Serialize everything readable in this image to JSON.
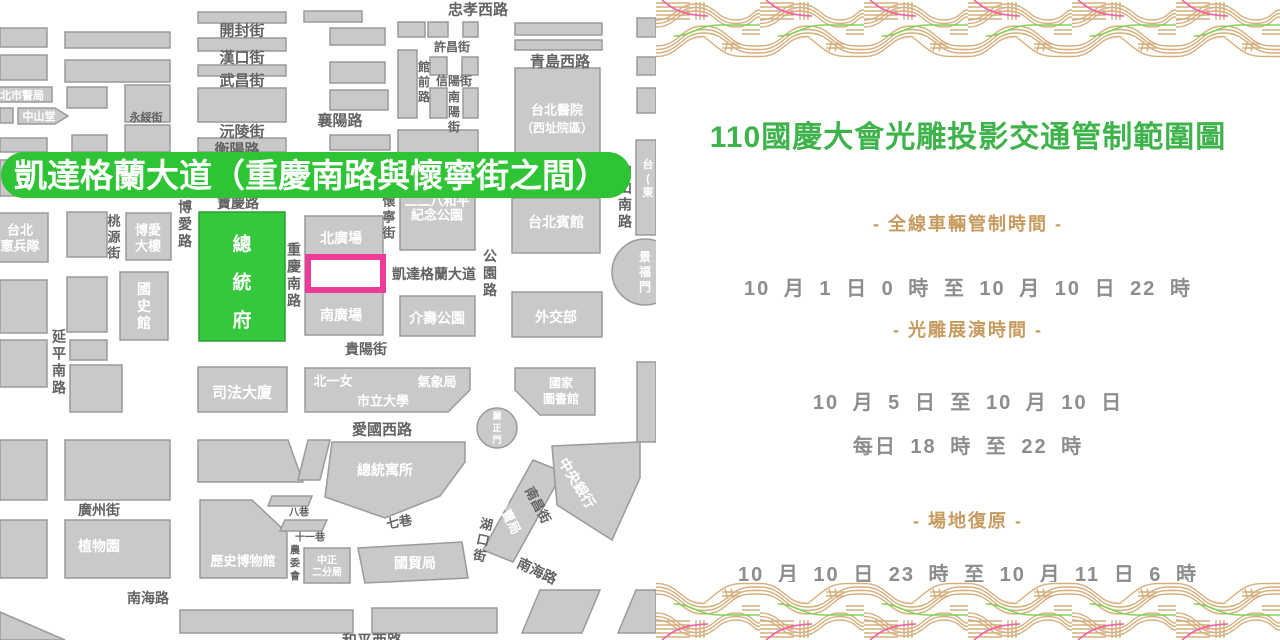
{
  "panel": {
    "title": "110國慶大會光雕投影交通管制範圍圖",
    "colors": {
      "title_green": "#3fb34b",
      "gold": "#c79b5f",
      "gray": "#8d8d8d"
    },
    "sections": [
      {
        "heading": "- 全線車輛管制時間 -",
        "lines": [
          "10 月  1 日 0 時 至  10 月 10 日 22 時"
        ]
      },
      {
        "heading": "- 光雕展演時間 -",
        "lines": [
          "10 月  5 日  至  10 月 10 日",
          "每日 18 時 至 22 時"
        ]
      },
      {
        "heading": "- 場地復原 -",
        "lines": [
          "10 月 10 日 23 時 至 10 月 11 日 6 時"
        ]
      }
    ]
  },
  "map": {
    "colors": {
      "block": "#c9c9cb",
      "blockBorder": "#9a9a9a",
      "street": "#636363",
      "green": "#35c83c",
      "greenBorder": "#2f9e33",
      "bannerGreen": "#2fc435",
      "pink": "#ee3a98"
    },
    "banner": {
      "text": "凱達格蘭大道（重慶南路與懷寧街之間）",
      "rect": [
        1,
        152,
        630,
        46
      ],
      "rx": 23,
      "fontSize": 33,
      "textX": 14,
      "textY": 187
    },
    "highlight": [
      308,
      257,
      75,
      33
    ],
    "shapes": [
      {
        "k": "r",
        "d": [
          0,
          28,
          47,
          19
        ]
      },
      {
        "k": "r",
        "d": [
          65,
          32,
          105,
          16
        ]
      },
      {
        "k": "r",
        "d": [
          198,
          12,
          88,
          11
        ]
      },
      {
        "k": "r",
        "d": [
          304,
          11,
          58,
          11
        ]
      },
      {
        "k": "r",
        "d": [
          0,
          55,
          47,
          25
        ]
      },
      {
        "k": "r",
        "d": [
          65,
          60,
          105,
          22
        ]
      },
      {
        "k": "r",
        "d": [
          198,
          38,
          88,
          13
        ]
      },
      {
        "k": "r",
        "d": [
          198,
          65,
          88,
          11
        ]
      },
      {
        "k": "r",
        "d": [
          198,
          88,
          88,
          34
        ]
      },
      {
        "k": "r",
        "d": [
          198,
          138,
          88,
          14
        ]
      },
      {
        "k": "r",
        "d": [
          -8,
          87,
          60,
          15
        ]
      },
      {
        "k": "r",
        "d": [
          67,
          87,
          40,
          21
        ]
      },
      {
        "k": "r",
        "d": [
          125,
          85,
          45,
          37
        ]
      },
      {
        "k": "r",
        "d": [
          0,
          108,
          13,
          15
        ]
      },
      {
        "k": "r",
        "d": [
          0,
          138,
          47,
          14
        ]
      },
      {
        "k": "r",
        "d": [
          72,
          135,
          35,
          17
        ]
      },
      {
        "k": "r",
        "d": [
          125,
          125,
          45,
          27
        ]
      },
      {
        "k": "r",
        "d": [
          0,
          160,
          47,
          36
        ]
      },
      {
        "k": "r",
        "d": [
          65,
          160,
          105,
          36
        ]
      },
      {
        "k": "r",
        "d": [
          198,
          160,
          88,
          36
        ]
      },
      {
        "k": "r",
        "d": [
          330,
          28,
          55,
          17
        ]
      },
      {
        "k": "r",
        "d": [
          330,
          62,
          55,
          21
        ]
      },
      {
        "k": "r",
        "d": [
          330,
          90,
          58,
          20
        ]
      },
      {
        "k": "r",
        "d": [
          330,
          135,
          60,
          15
        ]
      },
      {
        "k": "r",
        "d": [
          398,
          22,
          27,
          15
        ]
      },
      {
        "k": "r",
        "d": [
          428,
          22,
          20,
          15
        ]
      },
      {
        "k": "r",
        "d": [
          463,
          22,
          15,
          15
        ]
      },
      {
        "k": "r",
        "d": [
          398,
          50,
          19,
          68
        ]
      },
      {
        "k": "r",
        "d": [
          430,
          57,
          17,
          18
        ]
      },
      {
        "k": "r",
        "d": [
          462,
          57,
          16,
          18
        ]
      },
      {
        "k": "r",
        "d": [
          430,
          88,
          17,
          30
        ]
      },
      {
        "k": "r",
        "d": [
          463,
          88,
          15,
          30
        ]
      },
      {
        "k": "r",
        "d": [
          398,
          130,
          80,
          45
        ]
      },
      {
        "k": "r",
        "d": [
          515,
          23,
          87,
          12
        ]
      },
      {
        "k": "r",
        "d": [
          515,
          40,
          87,
          10
        ]
      },
      {
        "k": "r",
        "d": [
          515,
          68,
          85,
          85
        ]
      },
      {
        "k": "r",
        "d": [
          637,
          18,
          19,
          19
        ]
      },
      {
        "k": "r",
        "d": [
          637,
          57,
          19,
          18
        ]
      },
      {
        "k": "r",
        "d": [
          637,
          88,
          19,
          25
        ]
      },
      {
        "k": "r",
        "d": [
          636,
          140,
          20,
          95
        ]
      },
      {
        "k": "r",
        "d": [
          512,
          198,
          88,
          55
        ]
      },
      {
        "k": "r",
        "d": [
          400,
          192,
          75,
          58
        ]
      },
      {
        "k": "r",
        "d": [
          126,
          213,
          45,
          47
        ]
      },
      {
        "k": "r",
        "d": [
          67,
          212,
          40,
          45
        ]
      },
      {
        "k": "r",
        "d": [
          -15,
          213,
          63,
          49
        ]
      },
      {
        "k": "r",
        "d": [
          199,
          212,
          86,
          129
        ],
        "f": "g"
      },
      {
        "k": "r",
        "d": [
          120,
          272,
          48,
          68
        ]
      },
      {
        "k": "r",
        "d": [
          305,
          216,
          78,
          74
        ]
      },
      {
        "k": "r",
        "d": [
          305,
          290,
          78,
          45
        ]
      },
      {
        "k": "r",
        "d": [
          400,
          296,
          75,
          40
        ]
      },
      {
        "k": "r",
        "d": [
          512,
          292,
          90,
          45
        ]
      },
      {
        "k": "r",
        "d": [
          0,
          280,
          47,
          53
        ]
      },
      {
        "k": "r",
        "d": [
          67,
          277,
          40,
          55
        ]
      },
      {
        "k": "r",
        "d": [
          0,
          340,
          47,
          47
        ]
      },
      {
        "k": "r",
        "d": [
          70,
          340,
          37,
          20
        ]
      },
      {
        "k": "r",
        "d": [
          70,
          365,
          52,
          47
        ]
      },
      {
        "k": "r",
        "d": [
          198,
          367,
          89,
          45
        ]
      },
      {
        "k": "r",
        "d": [
          637,
          362,
          19,
          80
        ]
      },
      {
        "k": "r",
        "d": [
          0,
          440,
          47,
          60
        ]
      },
      {
        "k": "r",
        "d": [
          65,
          440,
          105,
          60
        ]
      },
      {
        "k": "r",
        "d": [
          0,
          520,
          47,
          58
        ]
      },
      {
        "k": "r",
        "d": [
          65,
          520,
          105,
          58
        ]
      },
      {
        "k": "r",
        "d": [
          304,
          548,
          46,
          35
        ]
      },
      {
        "k": "r",
        "d": [
          180,
          610,
          173,
          23
        ]
      },
      {
        "k": "r",
        "d": [
          372,
          608,
          125,
          25
        ]
      },
      {
        "k": "p",
        "d": "18,108 55,108 68,116 55,124 18,124"
      },
      {
        "k": "p",
        "d": "305,368 470,368 470,390 448,412 305,412"
      },
      {
        "k": "p",
        "d": "515,368 595,368 595,415 540,415 515,390"
      },
      {
        "k": "p",
        "d": "332,442 465,442 465,462 440,496 385,518 325,497"
      },
      {
        "k": "p",
        "d": "198,440 288,440 303,482 198,482"
      },
      {
        "k": "p",
        "d": "308,440 330,440 320,480 298,480"
      },
      {
        "k": "p",
        "d": "200,500 252,500 287,533 287,578 200,578"
      },
      {
        "k": "p",
        "d": "272,496 312,496 308,506 268,506"
      },
      {
        "k": "p",
        "d": "285,520 327,520 322,531 280,531"
      },
      {
        "k": "p",
        "d": "358,548 462,542 468,578 365,583"
      },
      {
        "k": "p",
        "d": "533,460 563,472 513,562 483,550"
      },
      {
        "k": "p",
        "d": "552,446 640,442 640,478 612,540 557,505"
      },
      {
        "k": "p",
        "d": "540,590 600,590 582,633 522,633"
      },
      {
        "k": "p",
        "d": "636,590 656,590 656,633 618,633"
      },
      {
        "k": "p",
        "d": "0,612 65,640 0,640"
      },
      {
        "k": "c",
        "d": [
          645,
          272,
          33
        ]
      },
      {
        "k": "c",
        "d": [
          497,
          428,
          20
        ]
      }
    ],
    "labels": [
      {
        "t": "忠孝西路",
        "x": 478,
        "y": 9,
        "s": 15
      },
      {
        "t": "開封街",
        "x": 242,
        "y": 30,
        "s": 15
      },
      {
        "t": "漢口街",
        "x": 242,
        "y": 57,
        "s": 15
      },
      {
        "t": "武昌街",
        "x": 242,
        "y": 80,
        "s": 15
      },
      {
        "t": "沅陵街",
        "x": 242,
        "y": 131,
        "s": 15
      },
      {
        "t": "衡陽路",
        "x": 237,
        "y": 149,
        "s": 15
      },
      {
        "t": "襄陽路",
        "x": 340,
        "y": 120,
        "s": 15
      },
      {
        "t": "永綏街",
        "x": 146,
        "y": 117,
        "s": 11
      },
      {
        "t": "許昌街",
        "x": 452,
        "y": 47,
        "s": 12
      },
      {
        "t": "信陽街",
        "x": 454,
        "y": 81,
        "s": 12
      },
      {
        "t": "青島西路",
        "x": 560,
        "y": 61,
        "s": 15
      },
      {
        "t": "寶慶路",
        "x": 238,
        "y": 203,
        "s": 14
      },
      {
        "t": "凱達格蘭大道",
        "x": 434,
        "y": 274,
        "s": 14
      },
      {
        "t": "貴陽街",
        "x": 366,
        "y": 349,
        "s": 14
      },
      {
        "t": "愛國西路",
        "x": 382,
        "y": 429,
        "s": 15
      },
      {
        "t": "廣州街",
        "x": 99,
        "y": 510,
        "s": 14
      },
      {
        "t": "南海路",
        "x": 148,
        "y": 598,
        "s": 14
      },
      {
        "t": "和平西路",
        "x": 372,
        "y": 640,
        "s": 15
      },
      {
        "t": "八巷",
        "x": 299,
        "y": 512,
        "s": 10
      },
      {
        "t": "十一巷",
        "x": 310,
        "y": 537,
        "s": 10
      },
      {
        "t": "七巷",
        "x": 399,
        "y": 522,
        "s": 13,
        "r": -10
      },
      {
        "t": "南昌街",
        "x": 538,
        "y": 505,
        "s": 13,
        "r": 62
      },
      {
        "t": "南海路",
        "x": 537,
        "y": 571,
        "s": 14,
        "r": 25
      },
      {
        "t": "館前路",
        "x": 424,
        "y": 82,
        "s": 12,
        "v": 1
      },
      {
        "t": "南陽街",
        "x": 454,
        "y": 112,
        "s": 12,
        "v": 1
      },
      {
        "t": "中山南路",
        "x": 625,
        "y": 196,
        "s": 14,
        "v": 1
      },
      {
        "t": "博愛路",
        "x": 185,
        "y": 224,
        "s": 14,
        "v": 1
      },
      {
        "t": "桃源街",
        "x": 114,
        "y": 237,
        "s": 13,
        "v": 1
      },
      {
        "t": "重慶南路",
        "x": 294,
        "y": 275,
        "s": 14,
        "v": 1
      },
      {
        "t": "懷寧街",
        "x": 389,
        "y": 217,
        "s": 13,
        "v": 1
      },
      {
        "t": "公園路",
        "x": 490,
        "y": 273,
        "s": 14,
        "v": 1
      },
      {
        "t": "延平南路",
        "x": 59,
        "y": 362,
        "s": 14,
        "v": 1
      },
      {
        "t": "農委會",
        "x": 295,
        "y": 563,
        "s": 10,
        "v": 1
      },
      {
        "t": "湖口街",
        "x": 483,
        "y": 540,
        "s": 13,
        "v": 1,
        "r": 12
      },
      {
        "t": "北市警局",
        "x": 22,
        "y": 95,
        "s": 11,
        "c": "w"
      },
      {
        "t": "中山堂",
        "x": 39,
        "y": 116,
        "s": 11,
        "c": "w"
      },
      {
        "t": "台北醫院",
        "x": 557,
        "y": 110,
        "s": 13,
        "c": "w"
      },
      {
        "t": "（西址院區）",
        "x": 557,
        "y": 128,
        "s": 12,
        "c": "w"
      },
      {
        "t": "台北賓館",
        "x": 556,
        "y": 222,
        "s": 14,
        "c": "w"
      },
      {
        "t": "二二八和平",
        "x": 437,
        "y": 201,
        "s": 13,
        "c": "w"
      },
      {
        "t": "紀念公園",
        "x": 437,
        "y": 215,
        "s": 13,
        "c": "w"
      },
      {
        "t": "總統府",
        "x": 242,
        "y": 282,
        "s": 19,
        "c": "w",
        "v": 1,
        "g": 38
      },
      {
        "t": "國史館",
        "x": 144,
        "y": 306,
        "s": 14,
        "c": "w",
        "v": 1
      },
      {
        "t": "博愛",
        "x": 148,
        "y": 230,
        "s": 13,
        "c": "w"
      },
      {
        "t": "大樓",
        "x": 148,
        "y": 246,
        "s": 13,
        "c": "w"
      },
      {
        "t": "台北",
        "x": 20,
        "y": 230,
        "s": 13,
        "c": "w"
      },
      {
        "t": "憲兵隊",
        "x": 20,
        "y": 246,
        "s": 13,
        "c": "w"
      },
      {
        "t": "北廣場",
        "x": 341,
        "y": 238,
        "s": 14,
        "c": "w"
      },
      {
        "t": "南廣場",
        "x": 341,
        "y": 315,
        "s": 14,
        "c": "w"
      },
      {
        "t": "介壽公園",
        "x": 437,
        "y": 318,
        "s": 14,
        "c": "w"
      },
      {
        "t": "外交部",
        "x": 556,
        "y": 317,
        "s": 14,
        "c": "w"
      },
      {
        "t": "司法大廈",
        "x": 242,
        "y": 392,
        "s": 15,
        "c": "w"
      },
      {
        "t": "景福門",
        "x": 645,
        "y": 272,
        "s": 12,
        "c": "w",
        "v": 1
      },
      {
        "t": "麗正門",
        "x": 497,
        "y": 428,
        "s": 9,
        "c": "w",
        "v": 1
      },
      {
        "t": "北一女",
        "x": 333,
        "y": 381,
        "s": 13,
        "c": "w"
      },
      {
        "t": "氣象局",
        "x": 437,
        "y": 382,
        "s": 13,
        "c": "w"
      },
      {
        "t": "市立大學",
        "x": 383,
        "y": 401,
        "s": 13,
        "c": "w"
      },
      {
        "t": "國家",
        "x": 561,
        "y": 383,
        "s": 12,
        "c": "w"
      },
      {
        "t": "圖書館",
        "x": 561,
        "y": 399,
        "s": 12,
        "c": "w"
      },
      {
        "t": "總統寓所",
        "x": 385,
        "y": 470,
        "s": 14,
        "c": "w"
      },
      {
        "t": "植物園",
        "x": 99,
        "y": 546,
        "s": 14,
        "c": "w"
      },
      {
        "t": "歷史博物館",
        "x": 243,
        "y": 561,
        "s": 13,
        "c": "w"
      },
      {
        "t": "中正",
        "x": 327,
        "y": 560,
        "s": 10,
        "c": "w"
      },
      {
        "t": "二分局",
        "x": 327,
        "y": 572,
        "s": 10,
        "c": "w"
      },
      {
        "t": "國貿局",
        "x": 415,
        "y": 563,
        "s": 14,
        "c": "w"
      },
      {
        "t": "公賣局",
        "x": 508,
        "y": 516,
        "s": 13,
        "c": "w",
        "r": 62
      },
      {
        "t": "中央銀行",
        "x": 577,
        "y": 483,
        "s": 14,
        "c": "w",
        "r": 58
      },
      {
        "t": "台(東",
        "x": 648,
        "y": 178,
        "s": 11,
        "c": "w",
        "v": 1
      }
    ]
  }
}
